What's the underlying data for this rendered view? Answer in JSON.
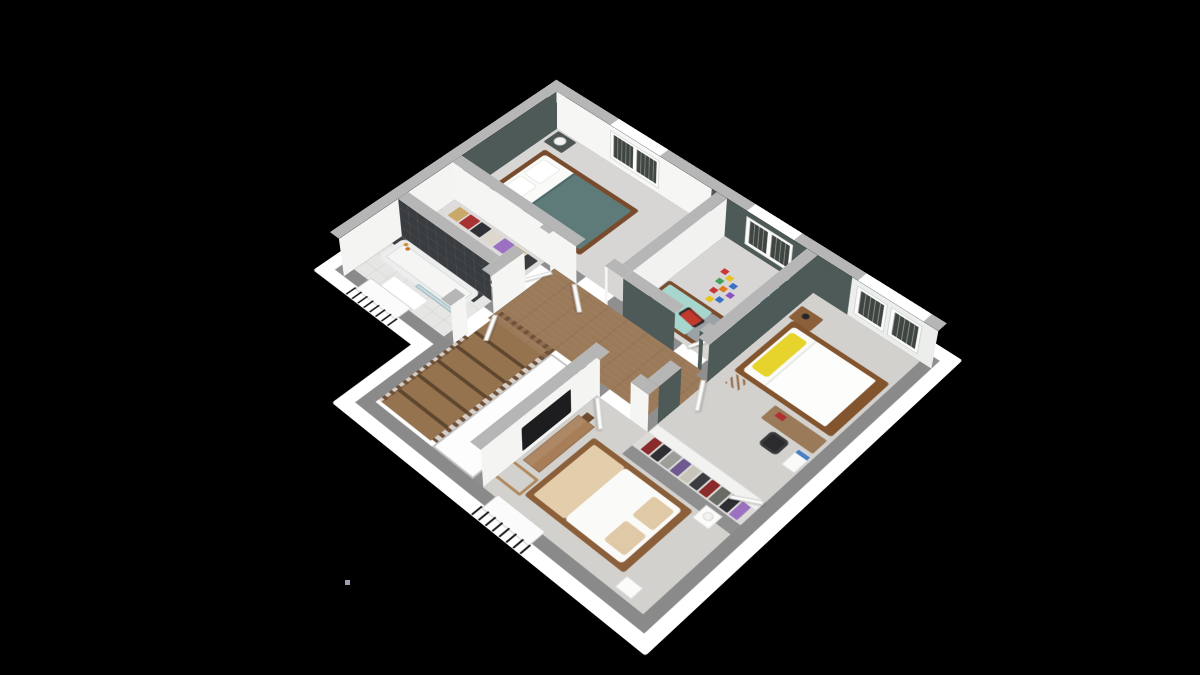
{
  "scene": {
    "type": "3d-dollhouse-floorplan",
    "background": "#000000",
    "floor_label": "upper floor of a house, isometric cutaway view, no visible text"
  },
  "colors": {
    "slab_white": "#ffffff",
    "wall_top": "#8f8f8f",
    "cut_wall": "#8a8a8a",
    "wall_cap": "#b6b6b6",
    "wall_face_white": "#f5f5f4",
    "accent_green": "#4d5a57",
    "carpet": "#d7d6d4",
    "carpet_warm": "#d3d1ce",
    "hall_wood": "#9b7a5a",
    "stair_wood": "#8a6a4b",
    "rail_wood": "#6f5138",
    "bath_tile": "#e6e6e4",
    "dark_tile": "#3a3d40",
    "tub_white": "#f5f5f4",
    "glass": "rgba(176,203,214,0.6)",
    "master_blanket": "#5e7b7a",
    "bed_wood": "#774b2c",
    "kids_blanket": "#a6d6ce",
    "yellow_pillow": "#e6d32b",
    "beige_bedding": "#e3cdab",
    "tv_black": "#1d1d1f",
    "chair_black": "#2b2b2d",
    "shelf_blue": "#4b81c2",
    "toy_red": "#c23a2e",
    "toy_pink": "#e58ab8",
    "shutter_dark": "#3f4540"
  },
  "rooms": [
    {
      "name": "master-bedroom",
      "furniture": [
        "double-bed-teal-blanket",
        "nightstand-with-lamp",
        "nightstand-with-lamp",
        "window-with-shutters"
      ]
    },
    {
      "name": "walk-in-closet",
      "furniture": [
        "clothes-rail",
        "clothes-rail"
      ]
    },
    {
      "name": "bathroom",
      "furniture": [
        "bathtub",
        "glass-shower-screen",
        "bath-mat",
        "window-with-railing",
        "toiletries"
      ]
    },
    {
      "name": "hallway-stairwell",
      "furniture": [
        "wood-stairs",
        "wood-railing",
        "stair-void"
      ]
    },
    {
      "name": "kids-bedroom",
      "furniture": [
        "single-bed-aqua",
        "cube-shelf-blue-bins",
        "toy-blocks",
        "toy-car-red",
        "nightstand",
        "window-with-shutters"
      ]
    },
    {
      "name": "bedroom-2",
      "furniture": [
        "double-bed-yellow-pillow",
        "side-table",
        "desk",
        "office-chair",
        "two-windows-with-shutters"
      ]
    },
    {
      "name": "dressing-corridor",
      "furniture": [
        "open-wardrobe-hanging-clothes",
        "wardrobe-door"
      ]
    },
    {
      "name": "bedroom-3",
      "furniture": [
        "double-bed-beige",
        "tv-sideboard",
        "tv",
        "bench",
        "nightstand-with-lamp",
        "window-with-railing"
      ]
    }
  ],
  "artifact_dot": {
    "x": 345,
    "y": 580,
    "color": "#9aa0ad"
  }
}
